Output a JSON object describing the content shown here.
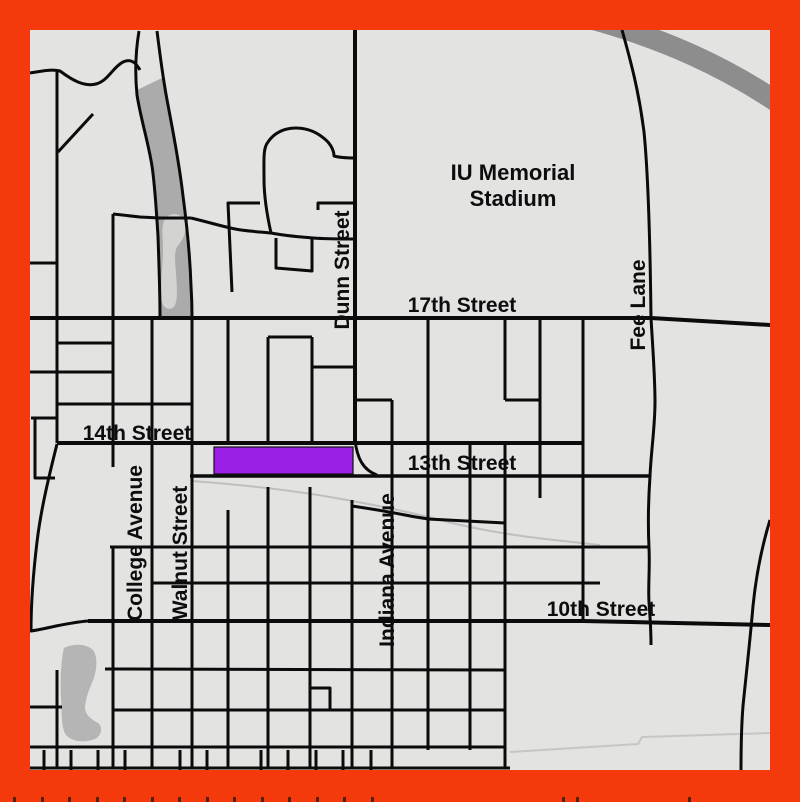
{
  "map": {
    "width": 800,
    "height": 802,
    "inner": {
      "x": 30,
      "y": 30,
      "w": 740,
      "h": 740
    },
    "colors": {
      "border": "#f4390d",
      "background": "#e3e3e1",
      "street": "#0b0b0b",
      "label": "#0d0d0d",
      "median_gray": "#ababab",
      "pond_gray": "#b5b5b5",
      "pond_light": "#d3d3d1",
      "highway_gray": "#8d8d8d",
      "trace_gray": "#bfbfbf",
      "tick": "#55200a"
    },
    "highlight": {
      "name": "highlighted-block",
      "x": 214,
      "y": 447,
      "w": 139,
      "h": 27,
      "fill": "#9a1ee6",
      "stroke": "#111111",
      "stroke_w": 1.2
    },
    "areas": [
      {
        "name": "median-wedge-area",
        "fill": "#ababab",
        "d": "M137,90 C141,118 148,140 152,165 C155,186 156,206 158,236 C159,266 160,291 160,317 L192,317 C192,310 192,300 191,286 C190,256 187,226 183,196 C179,161 173,132 168,105 C166,95 164,86 162,78 Z"
      },
      {
        "name": "median-pond-area",
        "fill": "#d3d3d1",
        "d": "M164,221 C168,212 182,211 185,223 C187,233 182,241 177,247 C174,253 175,261 176,273 C177,289 178,301 174,307 C167,312 161,306 161,295 C161,280 163,262 163,248 C163,236 161,229 164,221 Z"
      },
      {
        "name": "southwest-pond-area",
        "fill": "#b5b5b5",
        "d": "M64,648 C72,644 84,643 92,649 C98,655 97,668 94,678 C90,688 86,696 85,707 C85,715 91,719 98,723 C103,727 102,735 95,739 C85,743 72,742 66,735 C61,728 62,712 61,698 C60,680 61,659 64,648 Z"
      }
    ],
    "streets": [
      {
        "name": "gray-highway",
        "w": 21,
        "c": "#8d8d8d",
        "d": "M588,18 C662,38 724,66 780,104"
      },
      {
        "name": "rail-trace",
        "w": 2,
        "c": "#bfbfbf",
        "d": "M192,481 C245,485 290,490 330,497 C370,504 410,512 440,520 C470,528 510,535 545,539 L600,545"
      },
      {
        "name": "faint-south-line",
        "w": 2,
        "c": "#c6c6c6",
        "d": "M510,752 L638,744 L642,737 L770,733"
      },
      {
        "name": "nw-winding-road",
        "w": 3,
        "d": "M30,73 C42,71 52,69 60,71 C72,80 84,87 96,84 C108,81 113,67 123,62 C131,58 136,63 140,70"
      },
      {
        "name": "west-vertical-road",
        "w": 3,
        "d": "M57,70 L57,443"
      },
      {
        "name": "stub-road-a",
        "w": 3,
        "d": "M30,263 L57,263"
      },
      {
        "name": "stub-road-b",
        "w": 3,
        "d": "M57,343 L113,343"
      },
      {
        "name": "cross-road-a",
        "w": 3,
        "d": "M30,372 L113,372"
      },
      {
        "name": "cross-road-b",
        "w": 3,
        "d": "M57,404 L192,404"
      },
      {
        "name": "nw-diagonal-deadend",
        "w": 3,
        "d": "M58,152 L93,114"
      },
      {
        "name": "west-notch-road",
        "w": 3,
        "d": "M31,418 L57,418 M35,418 L35,478 L55,478"
      },
      {
        "name": "sw-curve-road",
        "w": 3,
        "d": "M57,444 C50,472 41,508 37,542 C34,567 31,597 31,631 C38,630 47,628 56,626 C66,624 76,622 88,621"
      },
      {
        "name": "wedge-left-road",
        "w": 3,
        "d": "M139,31 C135,55 135,75 137,95 C141,120 148,141 152,166 C155,186 156,206 158,236 C159,266 160,291 160,317"
      },
      {
        "name": "wedge-right-road",
        "w": 3,
        "d": "M157,31 C160,55 163,80 168,105 C173,132 179,161 183,196 C187,226 190,256 191,286 C192,301 192,311 192,317"
      },
      {
        "name": "cross-road-wedge",
        "w": 3,
        "d": "M113,214 L140,217 L160,218 L191,218"
      },
      {
        "name": "vertical-road-113",
        "w": 3,
        "d": "M113,214 L113,467"
      },
      {
        "name": "winding-mid-road",
        "w": 3,
        "d": "M191,218 C212,223 227,228 241,230 C256,232 263,232 271,233 C286,236 301,237 313,238 C326,239 341,239 355,239"
      },
      {
        "name": "loop-road",
        "w": 3,
        "d": "M271,233 C267,215 264,196 264,179 C264,159 263,148 268,142 C274,133 284,128 296,128 C309,128 320,134 328,142 C333,148 334,153 334,156 C341,158 348,158 355,158"
      },
      {
        "name": "spur-road",
        "w": 3,
        "d": "M318,210 L318,203 L355,203"
      },
      {
        "name": "l-street",
        "w": 3,
        "d": "M260,203 L228,203 L232,292"
      },
      {
        "name": "block-loop-road",
        "w": 3,
        "d": "M276,238 L276,268 L312,271 L312,238"
      },
      {
        "name": "dunn-street-line",
        "w": 4,
        "d": "M355,30 L355,443"
      },
      {
        "name": "dunn-street-curve",
        "w": 3,
        "d": "M355,440 C357,458 363,470 377,475"
      },
      {
        "name": "17th-street-line",
        "w": 4,
        "d": "M30,318 L651,318 L770,325"
      },
      {
        "name": "14th-street-line",
        "w": 4,
        "d": "M57,443 L583,443"
      },
      {
        "name": "13th-street-line",
        "w": 3.5,
        "d": "M190,476 L650,476"
      },
      {
        "name": "10th-street-line",
        "w": 4,
        "d": "M88,621 L583,621 L770,625"
      },
      {
        "name": "stub-y337",
        "w": 3,
        "d": "M268,337 L312,337"
      },
      {
        "name": "stub-y367",
        "w": 3,
        "d": "M312,367 L355,367"
      },
      {
        "name": "stub-y400",
        "w": 3,
        "d": "M355,400 L392,400"
      },
      {
        "name": "college-avenue-line",
        "w": 3,
        "d": "M152,318 L152,768"
      },
      {
        "name": "walnut-street-line",
        "w": 3,
        "d": "M192,318 L192,768"
      },
      {
        "name": "vertical-228-north",
        "w": 3,
        "d": "M228,318 L228,443"
      },
      {
        "name": "vertical-268-north",
        "w": 3,
        "d": "M268,337 L268,443"
      },
      {
        "name": "vertical-312-north",
        "w": 3,
        "d": "M312,337 L312,443"
      },
      {
        "name": "vertical-428",
        "w": 3,
        "d": "M428,318 L428,750"
      },
      {
        "name": "vertical-505-north",
        "w": 3,
        "d": "M505,318 L505,400"
      },
      {
        "name": "notch-y400",
        "w": 3,
        "d": "M505,400 L540,400"
      },
      {
        "name": "vertical-540",
        "w": 3,
        "d": "M540,318 L540,498"
      },
      {
        "name": "vertical-583",
        "w": 3,
        "d": "M583,318 L583,621"
      },
      {
        "name": "fee-lane-line",
        "w": 3,
        "d": "M622,30 C631,62 639,92 644,132 C648,172 650,232 651,318 C653,352 655,377 655,402 C655,427 651,452 650,476 C648,505 648,527 649,548 C650,567 648,587 649,602 C650,615 651,630 651,645"
      },
      {
        "name": "vertical-470",
        "w": 3,
        "d": "M470,443 L470,750"
      },
      {
        "name": "vertical-505-south",
        "w": 3,
        "d": "M505,443 L505,768"
      },
      {
        "name": "indiana-avenue-line",
        "w": 3,
        "d": "M392,400 L392,768"
      },
      {
        "name": "vertical-352-south",
        "w": 3,
        "d": "M352,500 L352,768"
      },
      {
        "name": "vertical-310-south",
        "w": 3,
        "d": "M310,487 L310,768"
      },
      {
        "name": "vertical-268-south",
        "w": 3,
        "d": "M268,487 L268,768"
      },
      {
        "name": "vertical-228-south",
        "w": 3,
        "d": "M228,510 L228,768"
      },
      {
        "name": "vertical-113-south",
        "w": 3,
        "d": "M113,547 L113,768"
      },
      {
        "name": "vertical-57-south",
        "w": 3,
        "d": "M57,670 L57,768"
      },
      {
        "name": "curving-road-y515",
        "w": 3,
        "d": "M352,506 C372,509 390,512 405,515 C415,517 422,518 428,519 L505,523"
      },
      {
        "name": "road-y547",
        "w": 3,
        "d": "M110,547 L650,547"
      },
      {
        "name": "road-y583",
        "w": 3,
        "d": "M152,583 L600,583"
      },
      {
        "name": "road-y670",
        "w": 3,
        "d": "M105,669 L505,670"
      },
      {
        "name": "road-y708",
        "w": 3,
        "d": "M30,707 L62,707 M113,710 L505,710"
      },
      {
        "name": "road-y747",
        "w": 3,
        "d": "M30,747 L505,747"
      },
      {
        "name": "road-y768",
        "w": 3,
        "d": "M30,768 L510,768"
      },
      {
        "name": "small-box-road",
        "w": 3,
        "d": "M310,688 L330,688 L330,710"
      },
      {
        "name": "se-curving-road",
        "w": 3,
        "d": "M770,520 C762,546 756,576 753,606 C750,641 746,676 743,706 C741,731 741,751 741,770"
      }
    ],
    "bottom_stubs": {
      "y1": 750,
      "y2": 770,
      "w": 3,
      "xs": [
        44,
        71,
        98,
        125,
        180,
        207,
        261,
        288,
        316,
        343,
        371
      ]
    },
    "under_border_ticks": {
      "y": 797,
      "h": 5,
      "w": 3,
      "color": "#55200a",
      "xs": [
        13,
        41,
        68,
        96,
        123,
        151,
        178,
        206,
        233,
        261,
        288,
        316,
        343,
        371,
        562,
        576,
        688
      ]
    },
    "labels": [
      {
        "name": "stadium-label-line-1",
        "text": "IU Memorial",
        "x": 513,
        "y": 180,
        "size": 22,
        "rotate": 0
      },
      {
        "name": "stadium-label-line-2",
        "text": "Stadium",
        "x": 513,
        "y": 206,
        "size": 22,
        "rotate": 0
      },
      {
        "name": "street-label-17th",
        "text": "17th Street",
        "x": 462,
        "y": 312,
        "size": 21,
        "rotate": 0
      },
      {
        "name": "street-label-14th",
        "text": "14th Street",
        "x": 137,
        "y": 440,
        "size": 21,
        "rotate": 0
      },
      {
        "name": "street-label-13th",
        "text": "13th Street",
        "x": 462,
        "y": 470,
        "size": 21,
        "rotate": 0
      },
      {
        "name": "street-label-10th",
        "text": "10th Street",
        "x": 601,
        "y": 616,
        "size": 21,
        "rotate": 0
      },
      {
        "name": "street-label-dunn",
        "text": "Dunn Street",
        "x": 349,
        "y": 270,
        "size": 21,
        "rotate": -90
      },
      {
        "name": "street-label-fee",
        "text": "Fee Lane",
        "x": 645,
        "y": 305,
        "size": 21,
        "rotate": -90
      },
      {
        "name": "street-label-college",
        "text": "College Avenue",
        "x": 142,
        "y": 543,
        "size": 21,
        "rotate": -90
      },
      {
        "name": "street-label-walnut",
        "text": "Walnut Street",
        "x": 187,
        "y": 553,
        "size": 21,
        "rotate": -90
      },
      {
        "name": "street-label-indiana",
        "text": "Indiana Avenue",
        "x": 394,
        "y": 570,
        "size": 21,
        "rotate": -90
      }
    ]
  }
}
